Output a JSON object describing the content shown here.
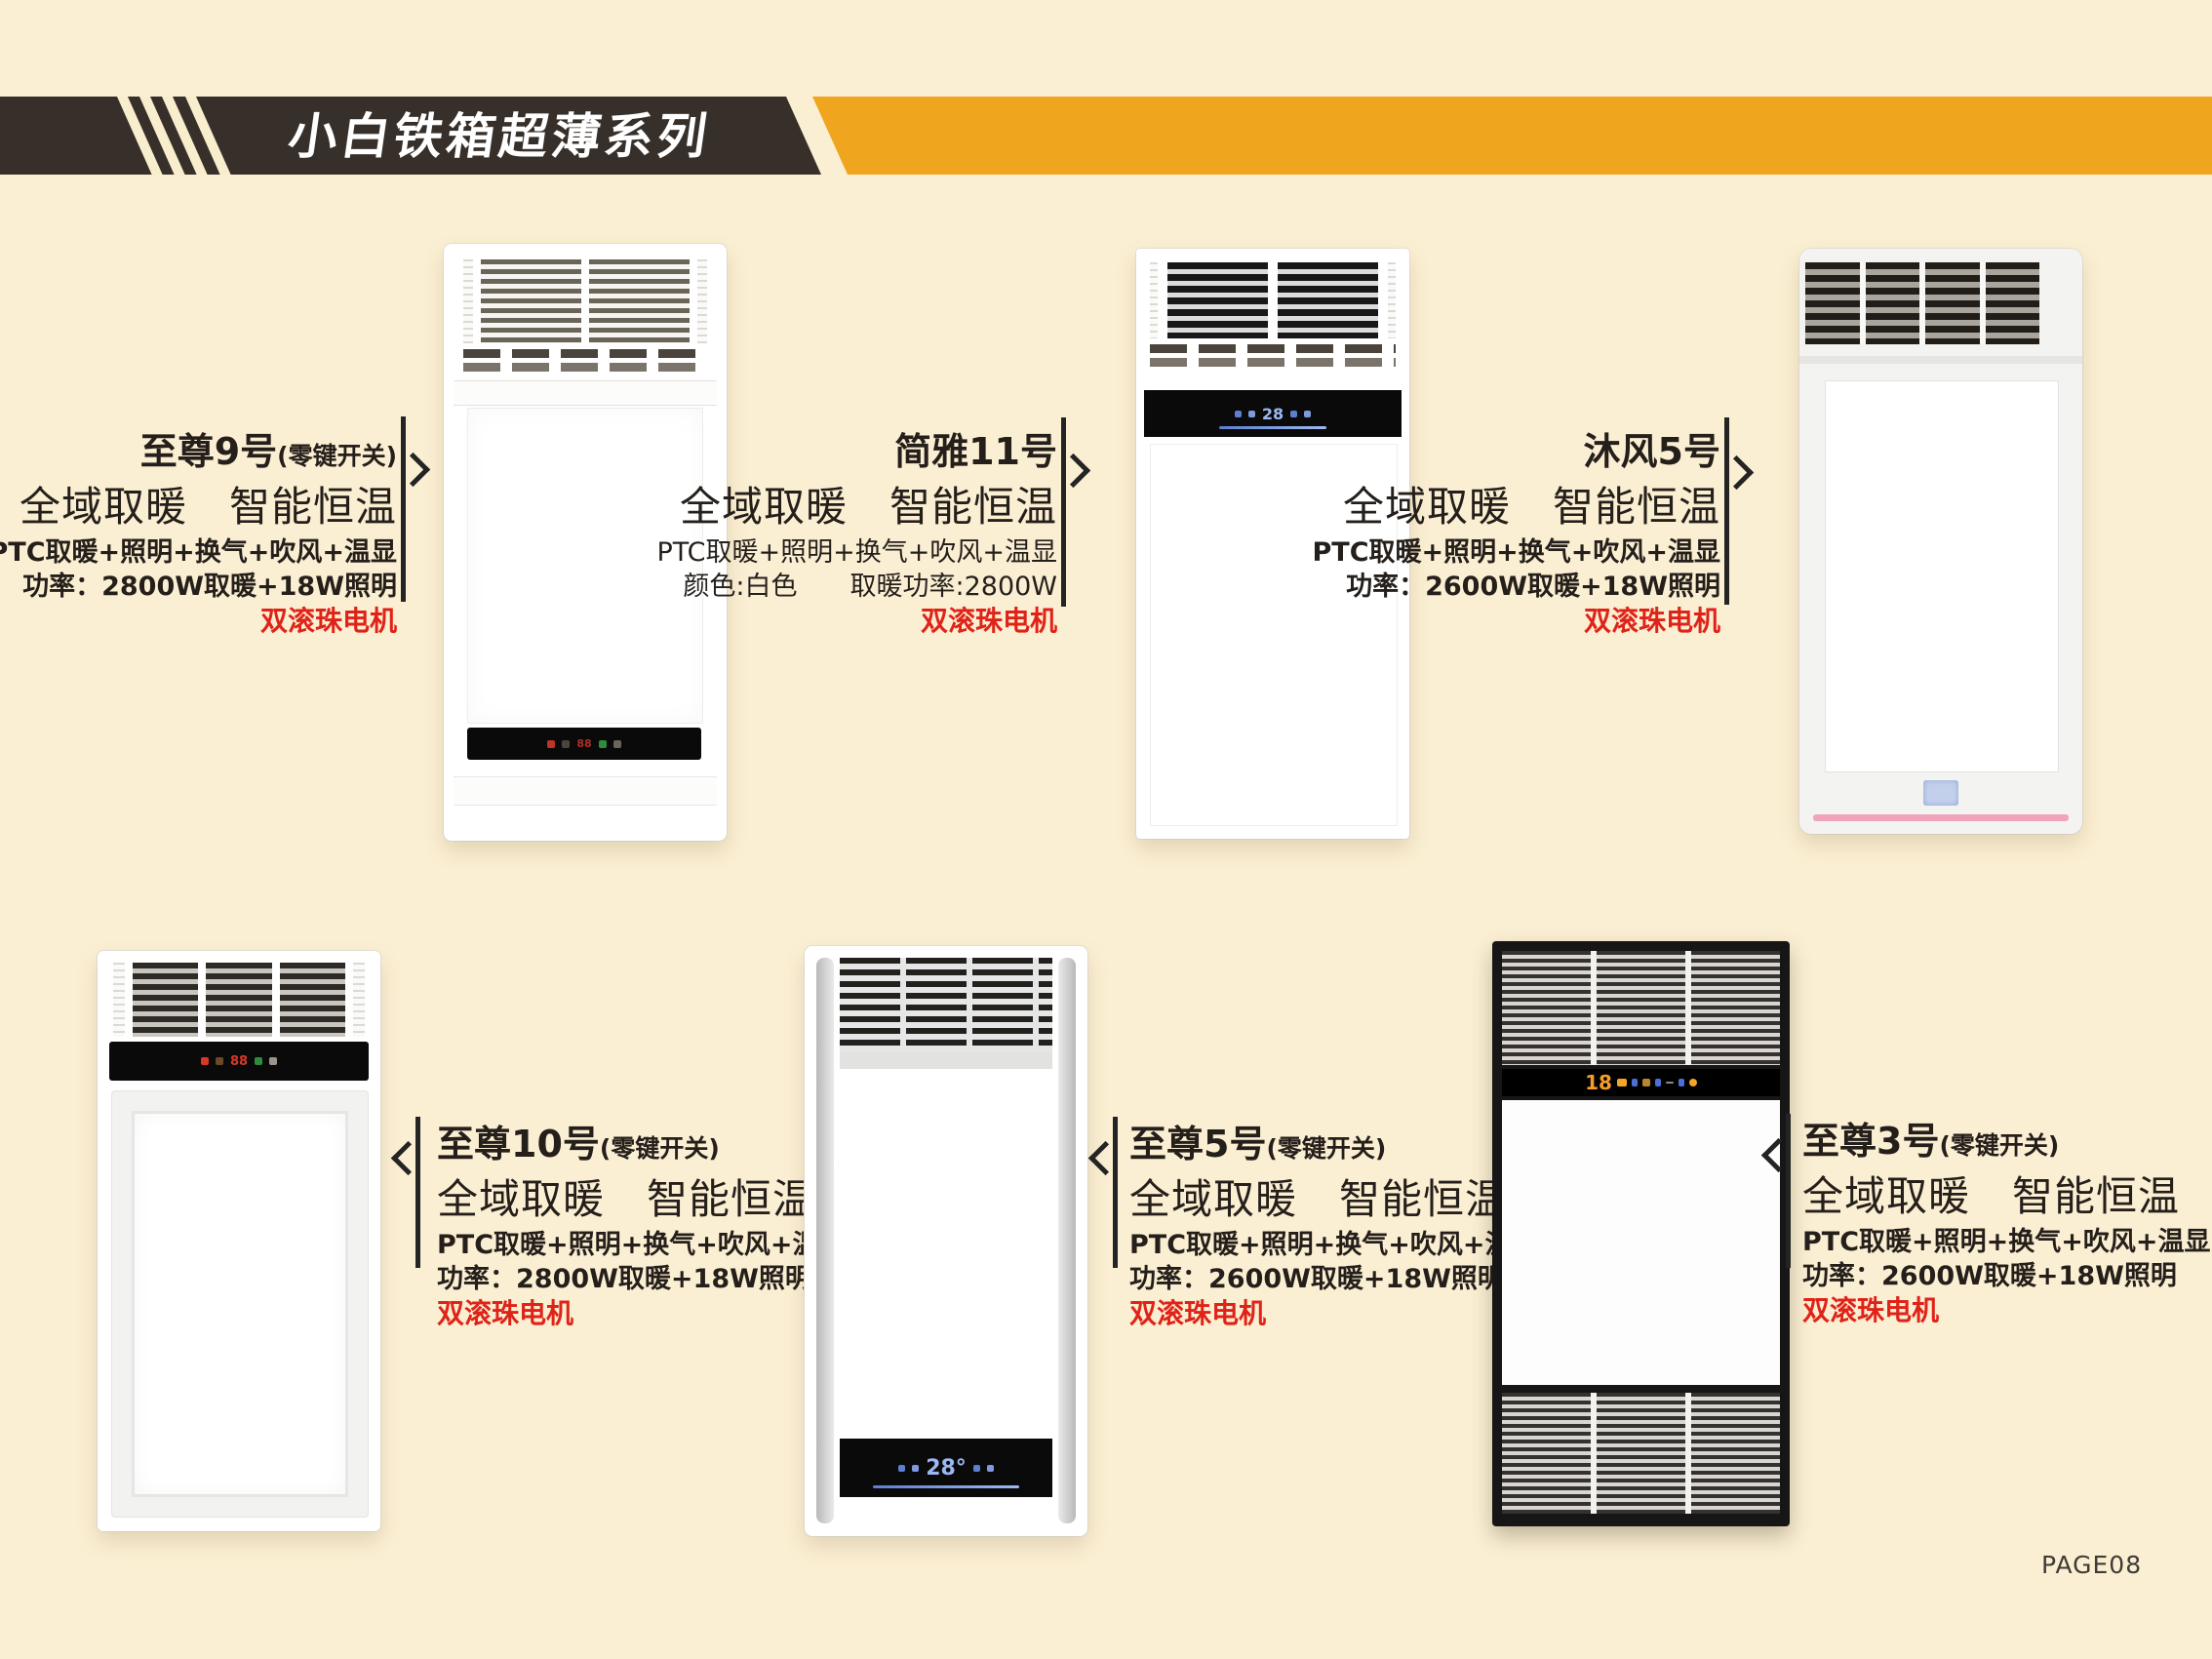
{
  "page": {
    "page_number": "PAGE08",
    "background": "#FBEFD3"
  },
  "banner": {
    "title": "小白铁箱超薄系列",
    "dark_color": "#37302A",
    "accent_color": "#F0A51E",
    "title_color": "#FFFFFF"
  },
  "colors": {
    "motor_red": "#E02318",
    "text_dark": "#251F1B",
    "led_blue": "#9CB8F4",
    "led_orange": "#F59D26",
    "pink_strip": "#F2A3BC"
  },
  "products": [
    {
      "name": "至尊9号",
      "suffix": "(零键开关)",
      "tagline": "全域取暖　智能恒温",
      "features": "PTC取暖+照明+换气+吹风+温显",
      "power": "功率：2800W取暖+18W照明",
      "motor": "双滚珠电机"
    },
    {
      "name": "简雅11号",
      "suffix": "",
      "tagline": "全域取暖　智能恒温",
      "features": "PTC取暖+照明+换气+吹风+温显",
      "power": "颜色:白色　　取暖功率:2800W",
      "motor": "双滚珠电机",
      "display": "28"
    },
    {
      "name": "沐风5号",
      "suffix": "",
      "tagline": "全域取暖　智能恒温",
      "features": "PTC取暖+照明+换气+吹风+温显",
      "power": "功率：2600W取暖+18W照明",
      "motor": "双滚珠电机"
    },
    {
      "name": "至尊10号",
      "suffix": "(零键开关)",
      "tagline": "全域取暖　智能恒温",
      "features": "PTC取暖+照明+换气+吹风+温显",
      "power": "功率：2800W取暖+18W照明",
      "motor": "双滚珠电机"
    },
    {
      "name": "至尊5号",
      "suffix": "(零键开关)",
      "tagline": "全域取暖　智能恒温",
      "features": "PTC取暖+照明+换气+吹风+温显",
      "power": "功率：2600W取暖+18W照明",
      "motor": "双滚珠电机",
      "display": "28°"
    },
    {
      "name": "至尊3号",
      "suffix": "(零键开关)",
      "tagline": "全域取暖　智能恒温",
      "features": "PTC取暖+照明+换气+吹风+温显",
      "power": "功率：2600W取暖+18W照明",
      "motor": "双滚珠电机",
      "display": "18"
    }
  ]
}
